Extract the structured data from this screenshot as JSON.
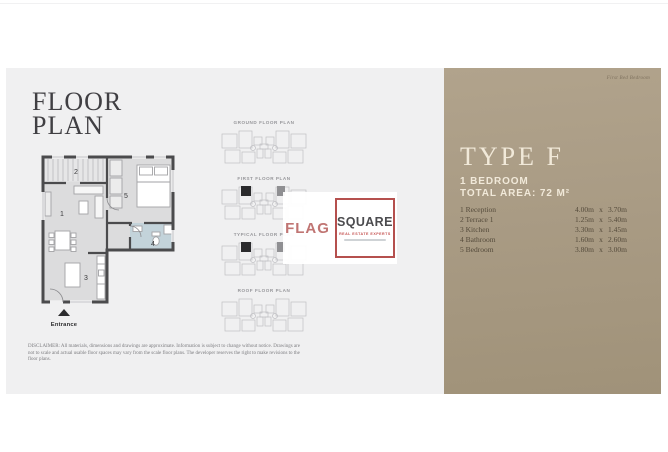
{
  "page": {
    "title_line1": "FLOOR",
    "title_line2": "PLAN",
    "entrance_label": "Entrance",
    "disclaimer": "DISCLAIMER: All materials, dimensions and drawings are approximate. Information is subject to change without notice. Drawings are not to scale and actual usable floor spaces may vary from the scale floor plans. The developer reserves the right to make revisions to the floor plans."
  },
  "main_plan": {
    "room_numbers": [
      "1",
      "2",
      "3",
      "4",
      "5"
    ]
  },
  "thumbnails": [
    {
      "label": "GROUND FLOOR PLAN",
      "variant": "outline"
    },
    {
      "label": "FIRST FLOOR PLAN",
      "variant": "marked"
    },
    {
      "label": "TYPICAL FLOOR PLAN",
      "variant": "marked"
    },
    {
      "label": "ROOF FLOOR PLAN",
      "variant": "outline"
    }
  ],
  "logo": {
    "word1": "FLAG",
    "word2": "SQUARE",
    "tagline": "REAL ESTATE EXPERTS"
  },
  "panel": {
    "watermark": "First Bed Bedroom",
    "type_title": "TYPE F",
    "bedroom_line": "1 BEDROOM",
    "area_line": "TOTAL AREA: 72 M²",
    "dim_separator": "x",
    "rooms": [
      {
        "name": "1 Reception",
        "w": "4.00m",
        "h": "3.70m"
      },
      {
        "name": "2 Terrace 1",
        "w": "1.25m",
        "h": "5.40m"
      },
      {
        "name": "3 Kitchen",
        "w": "3.30m",
        "h": "1.45m"
      },
      {
        "name": "4 Bathroom",
        "w": "1.60m",
        "h": "2.60m"
      },
      {
        "name": "5 Bedroom",
        "w": "3.80m",
        "h": "3.00m"
      }
    ]
  },
  "colors": {
    "page_bg": "#f0f0f1",
    "panel_bg": "#a99b84",
    "accent_red": "#b5504e",
    "cream": "#f1e9d9",
    "bath_blue": "#c3d3da",
    "wall": "#4b4b4d"
  }
}
